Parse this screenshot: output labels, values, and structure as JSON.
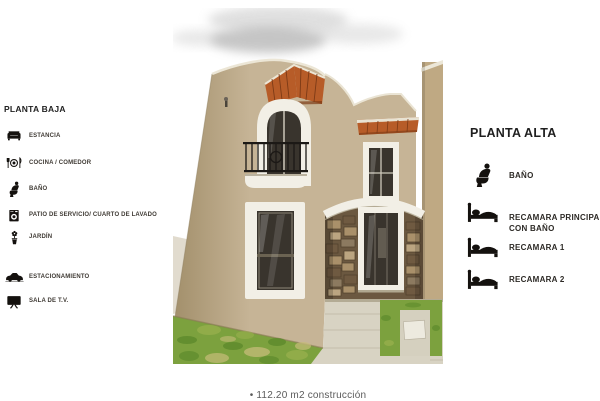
{
  "planta_baja": {
    "title": "PLANTA BAJA",
    "items": [
      {
        "icon": "sofa-icon",
        "label": "ESTANCIA"
      },
      {
        "icon": "dining-icon",
        "label": "COCINA / COMEDOR"
      },
      {
        "icon": "toilet-icon",
        "label": "BAÑO"
      },
      {
        "icon": "washer-icon",
        "label": "PATIO DE SERVICIO/ CUARTO DE LAVADO"
      },
      {
        "icon": "plant-icon",
        "label": "JARDÍN"
      },
      {
        "icon": "car-icon",
        "label": "ESTACIONAMIENTO"
      },
      {
        "icon": "tv-icon",
        "label": "SALA DE T.V."
      }
    ]
  },
  "planta_alta": {
    "title": "PLANTA ALTA",
    "items": [
      {
        "icon": "toilet-icon",
        "label": "BAÑO"
      },
      {
        "icon": "bed-icon",
        "label": "RECAMARA PRINCIPAL",
        "label2": "CON BAÑO"
      },
      {
        "icon": "bed-icon",
        "label": "RECAMARA 1"
      },
      {
        "icon": "bed-icon",
        "label": "RECAMARA 2"
      }
    ]
  },
  "footer": {
    "text": "•  112.20 m2 construcción"
  },
  "photo": {
    "description": "two-story beige stucco house, terracotta tile awnings, iron balcony, stone entry wall, lawn and walkway",
    "colors": {
      "wall": "#c6b496",
      "wall_dark": "#a3906c",
      "trim": "#f2efe6",
      "awning": "#b75c28",
      "awning_dark": "#7c3a16",
      "stone_mortar": "#6b5840",
      "glass": "#39342d",
      "iron": "#1c1916",
      "grass": "#7ca13e",
      "walkway": "#d8d3c3",
      "cloud": "#c6c6c6",
      "side_wall": "#bfa983"
    }
  },
  "text_colors": {
    "heading": "#1f1f1f",
    "label": "#3f3a34",
    "footer": "#5a5a5a"
  }
}
